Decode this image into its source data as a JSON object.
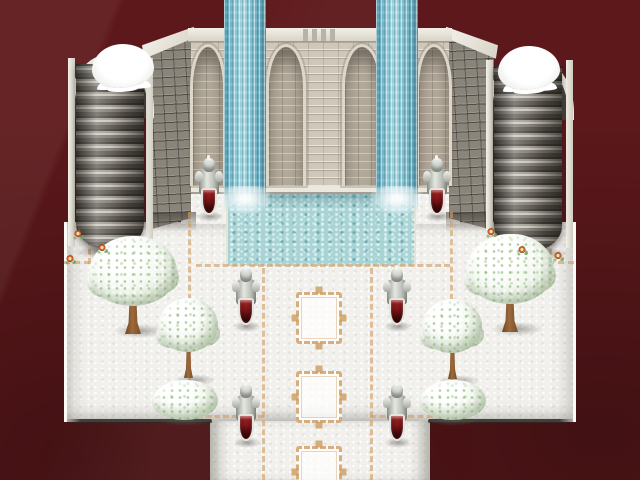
{
  "viewport": {
    "width": 640,
    "height": 480
  },
  "palette": {
    "background_maroon": "#5d181b",
    "stone_light": "#cfc8ba",
    "stone_dark": "#8a857b",
    "trim_white": "#eceadf",
    "waterfall_teal": "#8ecbd8",
    "pool_water": "#a9d4d6",
    "snow_ground": "#f1f0ec",
    "path_border_tan": "#d09e62",
    "shield_red": "#8e1a1c",
    "foliage_green": "#8fc47e",
    "trunk_brown": "#8b5a33"
  },
  "scene": {
    "knights": [
      {
        "x": 194,
        "y": 158
      },
      {
        "x": 422,
        "y": 158
      },
      {
        "x": 231,
        "y": 268
      },
      {
        "x": 382,
        "y": 268
      },
      {
        "x": 231,
        "y": 384
      },
      {
        "x": 382,
        "y": 384
      }
    ],
    "trees": [
      {
        "x": 87,
        "y": 236,
        "type": "large"
      },
      {
        "x": 464,
        "y": 234,
        "type": "large"
      },
      {
        "x": 156,
        "y": 298,
        "type": "medium"
      },
      {
        "x": 420,
        "y": 299,
        "type": "medium"
      }
    ],
    "bushes": [
      {
        "x": 152,
        "y": 380
      },
      {
        "x": 420,
        "y": 380
      }
    ],
    "flowers": [
      {
        "x": 74,
        "y": 230
      },
      {
        "x": 66,
        "y": 255
      },
      {
        "x": 98,
        "y": 244
      },
      {
        "x": 487,
        "y": 228
      },
      {
        "x": 554,
        "y": 252
      },
      {
        "x": 518,
        "y": 246
      }
    ],
    "ornate_tiles": [
      {
        "x": 296,
        "y": 292
      },
      {
        "x": 296,
        "y": 371
      },
      {
        "x": 296,
        "y": 446
      }
    ],
    "waterfalls": [
      {
        "x": 224
      },
      {
        "x": 376
      }
    ],
    "borders_v": [
      {
        "x": 188,
        "y": 212,
        "h": 206
      },
      {
        "x": 450,
        "y": 212,
        "h": 206
      },
      {
        "x": 262,
        "y": 268,
        "h": 212
      },
      {
        "x": 370,
        "y": 268,
        "h": 212
      },
      {
        "x": 88,
        "y": 230,
        "h": 34
      },
      {
        "x": 549,
        "y": 230,
        "h": 34
      }
    ],
    "borders_h": [
      {
        "x": 196,
        "y": 264,
        "w": 254
      },
      {
        "x": 188,
        "y": 415,
        "w": 76
      },
      {
        "x": 370,
        "y": 415,
        "w": 82
      },
      {
        "x": 64,
        "y": 261,
        "w": 26
      },
      {
        "x": 548,
        "y": 261,
        "w": 26
      }
    ]
  }
}
